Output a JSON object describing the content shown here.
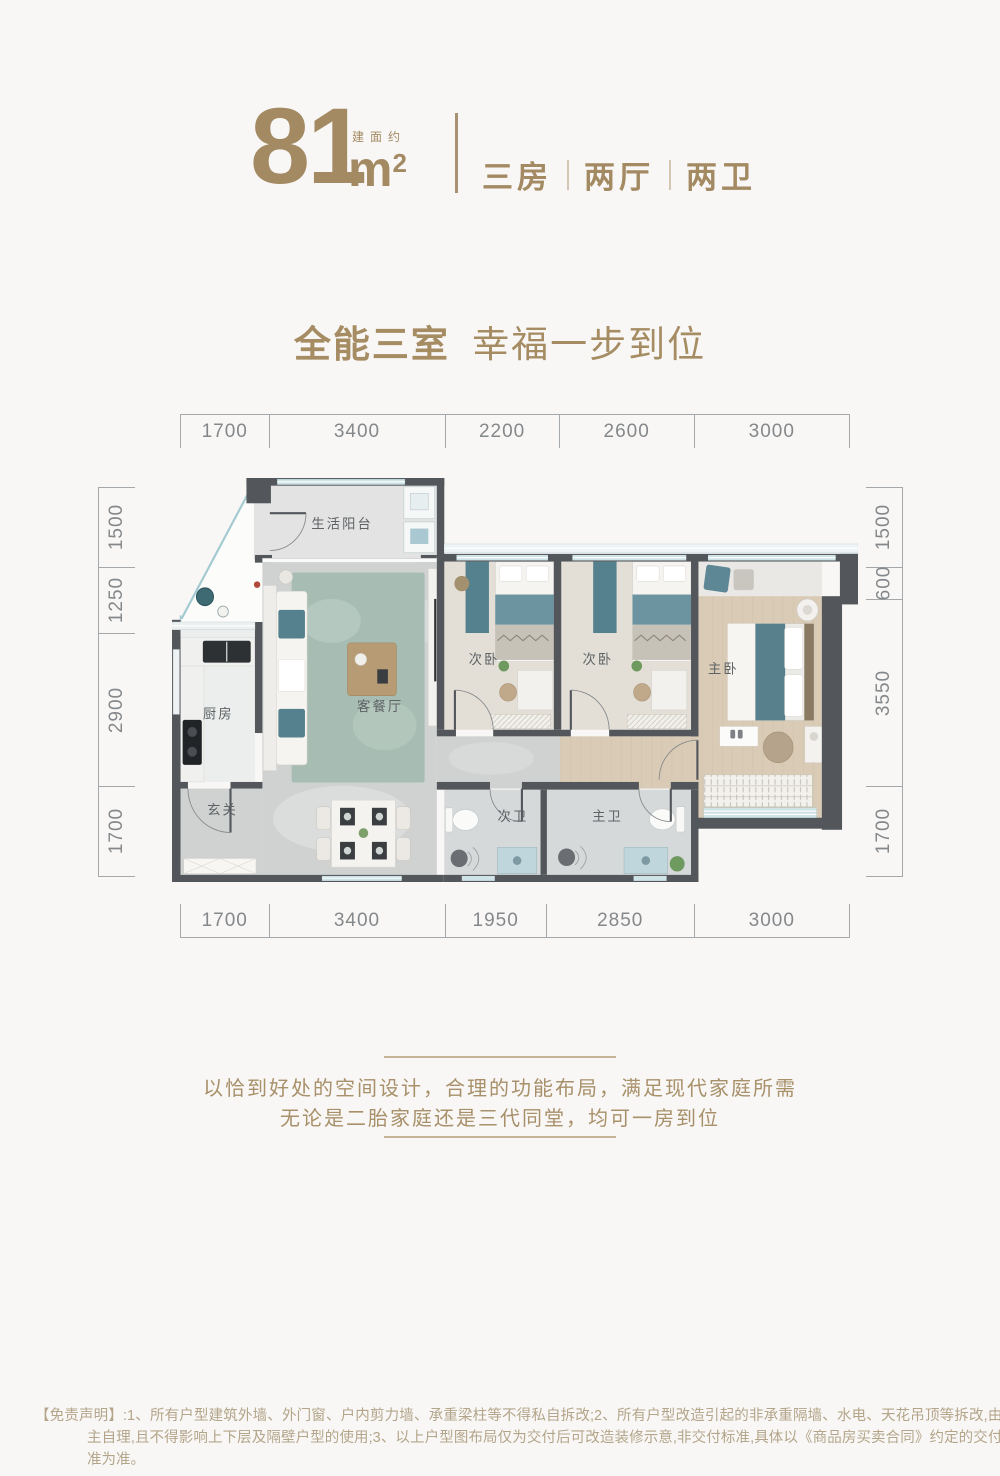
{
  "header": {
    "area_number": "81",
    "area_unit": "m",
    "area_sup": "2",
    "area_label": "建面约",
    "features": [
      "三房",
      "两厅",
      "两卫"
    ],
    "accent_color": "#a38a62"
  },
  "slogan": {
    "main": "全能三室",
    "sub": "幸福一步到位"
  },
  "dimensions": {
    "top": [
      "1700",
      "3400",
      "2200",
      "2600",
      "3000"
    ],
    "bottom": [
      "1700",
      "3400",
      "1950",
      "2850",
      "3000"
    ],
    "left": [
      "1500",
      "1250",
      "2900",
      "1700"
    ],
    "right": [
      "1500",
      "600",
      "3550",
      "1700"
    ]
  },
  "floorplan": {
    "rooms": {
      "balcony": "生活阳台",
      "kitchen": "厨房",
      "living_dining": "客餐厅",
      "bedroom_a": "次卧",
      "bedroom_b": "次卧",
      "master": "主卧",
      "foyer": "玄关",
      "bath_secondary": "次卫",
      "bath_master": "主卫"
    },
    "colors": {
      "wall": "#53575b",
      "window": "#cfe3e7",
      "marble_floor": "#d0d2d2",
      "wood_floor": "#d9cbb5",
      "rug": "#a7bdb3",
      "teal_accent": "#55808d"
    }
  },
  "description": {
    "line1": "以恰到好处的空间设计，合理的功能布局，满足现代家庭所需",
    "line2": "无论是二胎家庭还是三代同堂，均可一房到位"
  },
  "disclaimer": {
    "prefix": "【免责声明】:",
    "text": "1、所有户型建筑外墙、外门窗、户内剪力墙、承重梁柱等不得私自拆改;2、所有户型改造引起的非承重隔墙、水电、天花吊顶等拆改,由业主自理,且不得影响上下层及隔壁户型的使用;3、以上户型图布局仅为交付后可改造装修示意,非交付标准,具体以《商品房买卖合同》约定的交付标准为准。"
  }
}
